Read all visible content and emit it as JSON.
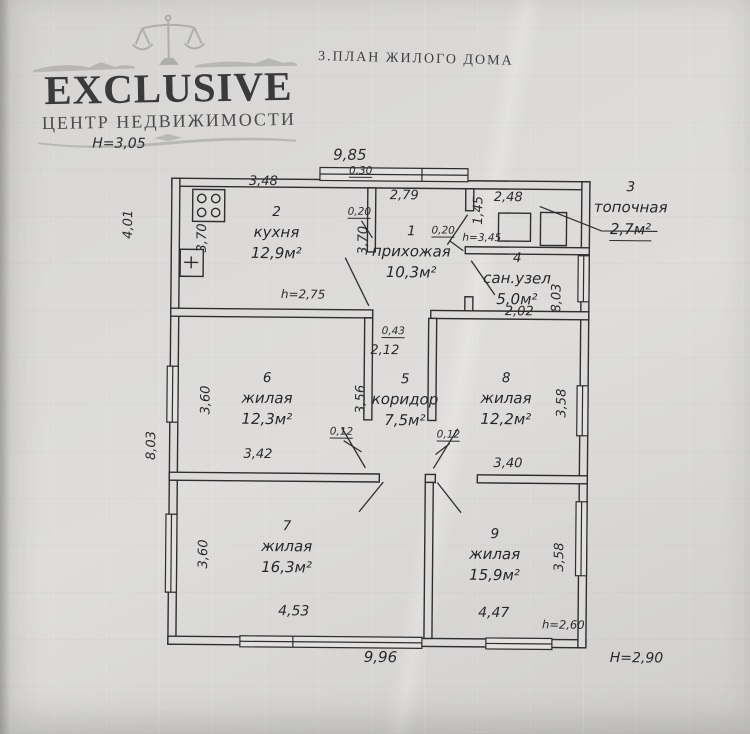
{
  "watermark": {
    "brand": "EXCLUSIVE",
    "subtitle": "ЦЕНТР НЕДВИЖИМОСТИ",
    "icon": "scales-icon"
  },
  "title": "3.ПЛАН ЖИЛОГО ДОМА",
  "rooms": {
    "r1": {
      "number": "1",
      "name": "прихожая",
      "area": "10,3м²"
    },
    "r2": {
      "number": "2",
      "name": "кухня",
      "area": "12,9м²"
    },
    "r3": {
      "number": "3",
      "name": "топочная",
      "area": "2,7м²"
    },
    "r4": {
      "number": "4",
      "name": "сан.узел",
      "area": "5,0м²"
    },
    "r5": {
      "number": "5",
      "name": "коридор",
      "area": "7,5м²"
    },
    "r6": {
      "number": "6",
      "name": "жилая",
      "area": "12,3м²"
    },
    "r7": {
      "number": "7",
      "name": "жилая",
      "area": "16,3м²"
    },
    "r8": {
      "number": "8",
      "name": "жилая",
      "area": "12,2м²"
    },
    "r9": {
      "number": "9",
      "name": "жилая",
      "area": "15,9м²"
    }
  },
  "dimensions": {
    "top_total": "9,85",
    "top_wall": "0,30",
    "kitchen_top": "3,48",
    "hall_top": "2,79",
    "boiler_top": "2,48",
    "left_upper": "4,01",
    "kitchen_left": "3,70",
    "hall_left": "3,70",
    "wall_kitchen_hall": "0,20",
    "wall_hall_san": "0,20",
    "boiler_left": "1,45",
    "san_right": "8,03",
    "san_bottom": "2,02",
    "wall_mid": "0,43",
    "corridor_top": "2,12",
    "room6_left": "3,60",
    "corridor_left": "3,56",
    "room8_right": "3,58",
    "wall_room6": "0,12",
    "wall_room8": "0,12",
    "room6_bottom": "3,42",
    "room8_bottom": "3,40",
    "left_lower": "8,03",
    "room7_left": "3,60",
    "room9_right": "3,58",
    "room7_bottom": "4,53",
    "room9_bottom": "4,47",
    "bottom_total": "9,96"
  },
  "heights": {
    "exterior_left": "H=3,05",
    "exterior_right": "H=2,90",
    "kitchen": "h=2,75",
    "boiler": "h=3,45",
    "room9": "h=2,60"
  },
  "icons": {
    "kitchen_stove": "stove-icon",
    "kitchen_sink": "sink-icon",
    "boiler_unit": "boiler-icon"
  }
}
